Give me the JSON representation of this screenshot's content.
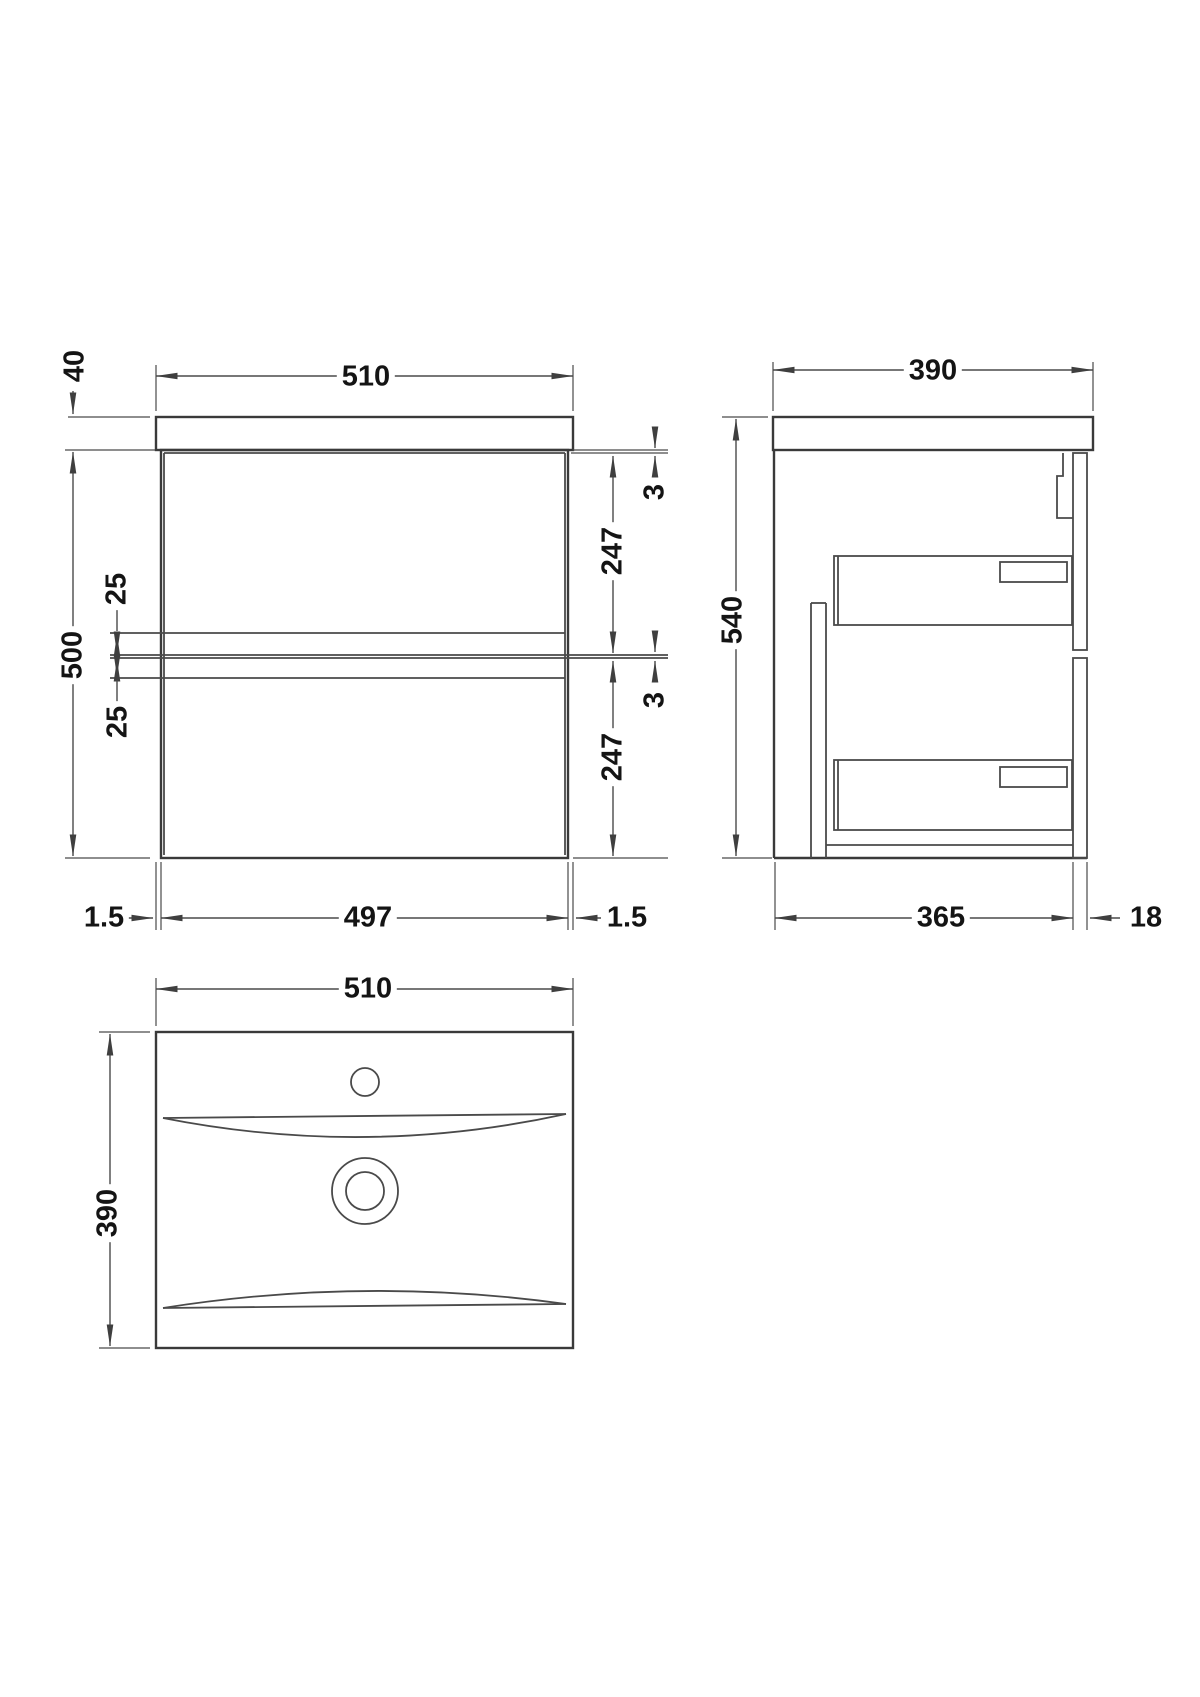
{
  "drawing": {
    "front": {
      "width_top": "510",
      "worktop_thickness": "40",
      "cabinet_height": "500",
      "reveal_top": "25",
      "reveal_bottom": "25",
      "gap_top": "3",
      "drawer1_height": "247",
      "gap_mid": "3",
      "drawer2_height": "247",
      "edge_left": "1.5",
      "inner_width": "497",
      "edge_right": "1.5"
    },
    "side": {
      "depth_top": "390",
      "overall_height": "540",
      "body_depth": "365",
      "front_thickness": "18"
    },
    "plan": {
      "width": "510",
      "depth": "390"
    },
    "colors": {
      "line": "#3a3a3a",
      "text": "#141414",
      "background": "#ffffff"
    }
  }
}
